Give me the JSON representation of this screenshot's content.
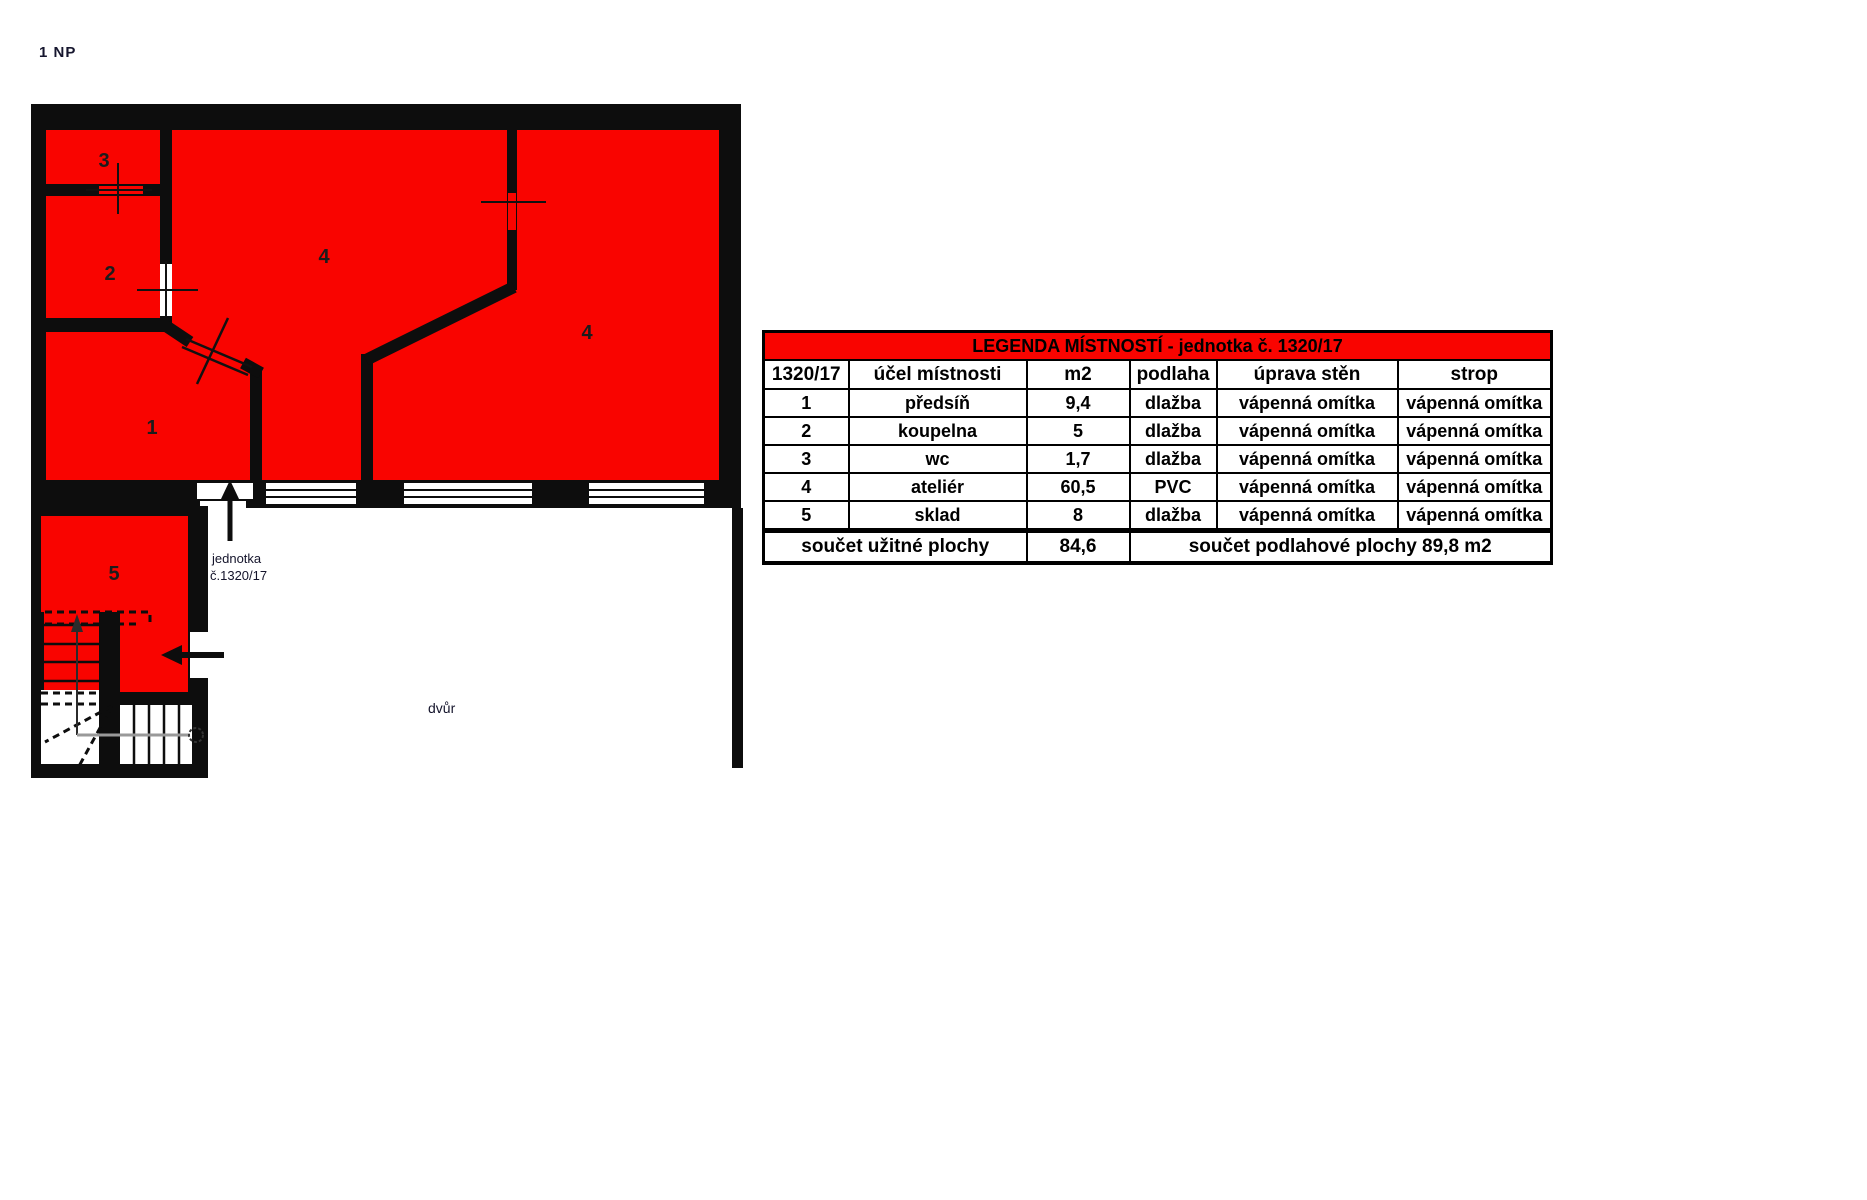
{
  "page": {
    "floor_label": "1 NP"
  },
  "plan": {
    "room_numbers": {
      "r1": "1",
      "r2": "2",
      "r3": "3",
      "r4a": "4",
      "r4b": "4",
      "r5": "5"
    },
    "unit_label_line1": "jednotka",
    "unit_label_line2": "č.1320/17",
    "courtyard_label": "dvůr",
    "colors": {
      "room_fill": "#f90400",
      "wall": "#0d0d0d",
      "walkline_gray": "#999999"
    }
  },
  "legend_table": {
    "title": "LEGENDA MÍSTNOSTÍ  - jednotka č. 1320/17",
    "columns": [
      "1320/17",
      "účel místnosti",
      "m2",
      "podlaha",
      "úprava stěn",
      "strop"
    ],
    "rows": [
      [
        "1",
        "předsíň",
        "9,4",
        "dlažba",
        "vápenná omítka",
        "vápenná omítka"
      ],
      [
        "2",
        "koupelna",
        "5",
        "dlažba",
        "vápenná omítka",
        "vápenná omítka"
      ],
      [
        "3",
        "wc",
        "1,7",
        "dlažba",
        "vápenná omítka",
        "vápenná omítka"
      ],
      [
        "4",
        "ateliér",
        "60,5",
        "PVC",
        "vápenná omítka",
        "vápenná omítka"
      ],
      [
        "5",
        "sklad",
        "8",
        "dlažba",
        "vápenná omítka",
        "vápenná omítka"
      ]
    ],
    "footer": {
      "left": "součet užitné plochy",
      "m2": "84,6",
      "right": "součet podlahové plochy 89,8 m2"
    }
  }
}
